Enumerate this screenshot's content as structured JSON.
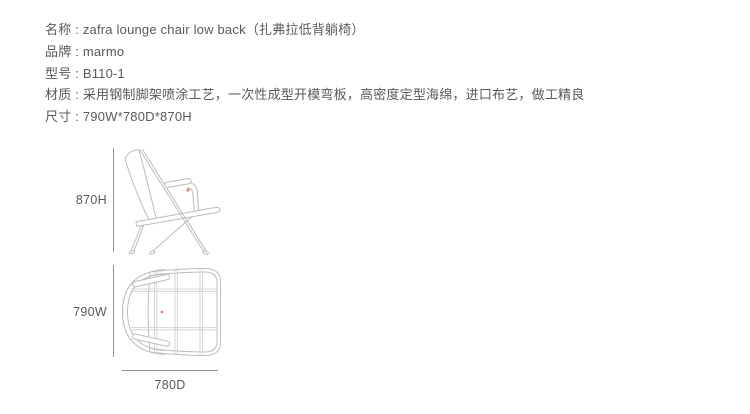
{
  "colors": {
    "background": "#ffffff",
    "text": "#58595b",
    "line_art": "#bcbcbc",
    "grid": "#cdcdcd",
    "dimension": "#8f8f8f",
    "marker": "#d2574e"
  },
  "spec": {
    "lines": [
      "名称 : zafra lounge chair low back（扎弗拉低背躺椅）",
      "品牌 : marmo",
      "型号 : B110-1",
      "材质 : 采用钢制脚架喷涂工艺，一次性成型开模弯板，高密度定型海绵，进口布艺，做工精良",
      "尺寸 : 790W*780D*870H"
    ]
  },
  "figure": {
    "side_view": {
      "height_label": "870H"
    },
    "top_view": {
      "width_label": "790W",
      "depth_label": "780D"
    }
  }
}
